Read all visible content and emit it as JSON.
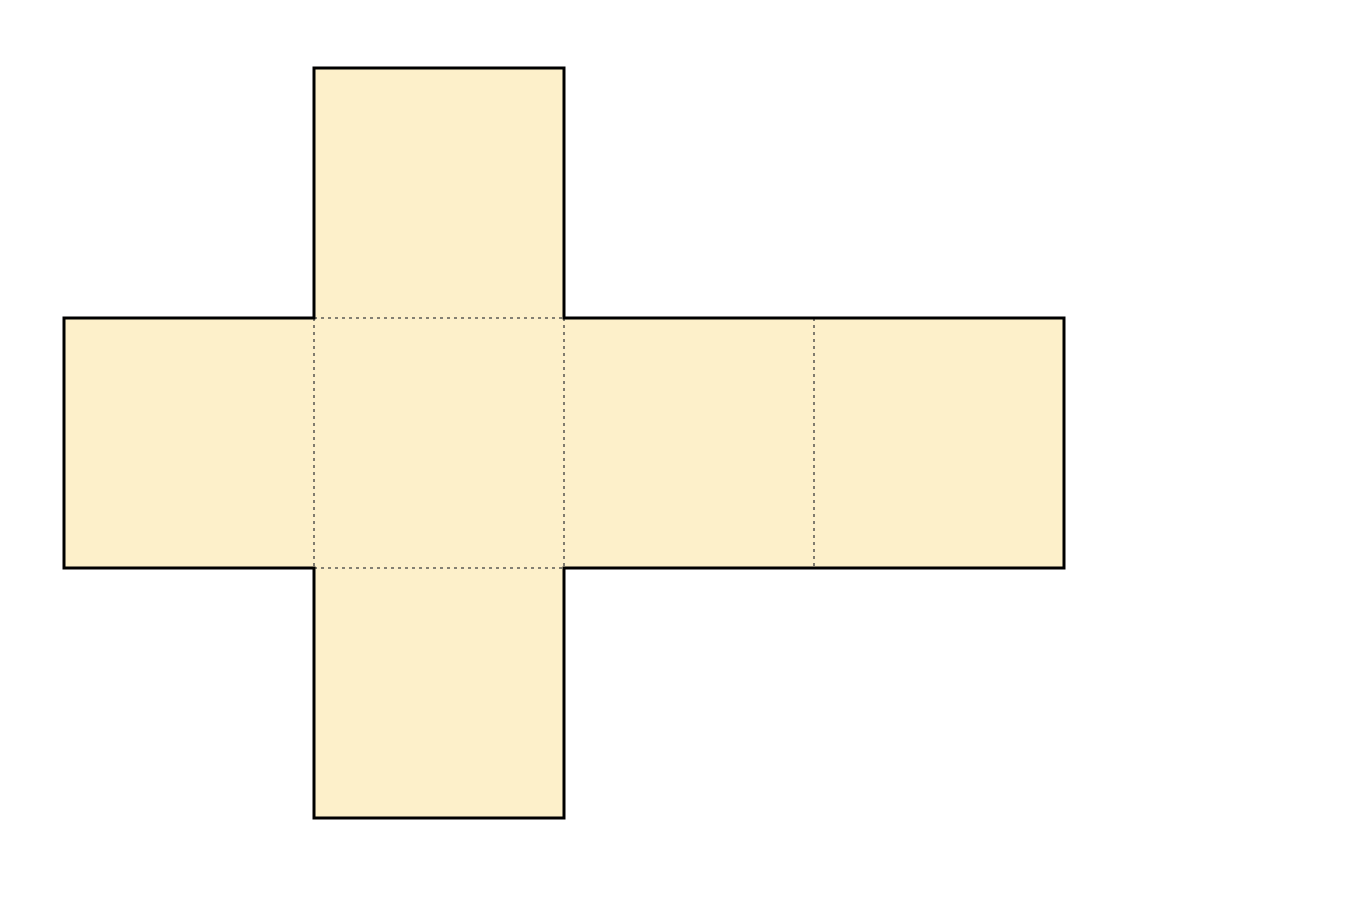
{
  "diagram": {
    "kind": "cube-net",
    "description": "Unfolded cube net: horizontal row of four squares with one square flap above and one below the second square",
    "canvas": {
      "width": 1352,
      "height": 899,
      "background": "#ffffff"
    },
    "style": {
      "face_fill": "#FDF0CA",
      "outline_color": "#000000",
      "outline_width": 3,
      "fold_line_color": "#3d3d3d",
      "fold_line_width": 1.3,
      "fold_line_dash": "3 4"
    },
    "grid": {
      "square_size": 250,
      "origin_x": 64,
      "origin_y": 68
    },
    "faces": [
      {
        "name": "face-top-flap",
        "x": 314,
        "y": 68,
        "w": 250,
        "h": 250
      },
      {
        "name": "face-row-left",
        "x": 64,
        "y": 318,
        "w": 250,
        "h": 250
      },
      {
        "name": "face-row-center",
        "x": 314,
        "y": 318,
        "w": 250,
        "h": 250
      },
      {
        "name": "face-row-right-1",
        "x": 564,
        "y": 318,
        "w": 250,
        "h": 250
      },
      {
        "name": "face-row-right-2",
        "x": 814,
        "y": 318,
        "w": 250,
        "h": 250
      },
      {
        "name": "face-bottom-flap",
        "x": 314,
        "y": 568,
        "w": 250,
        "h": 250
      }
    ],
    "outline_points": "314,68 564,68 564,318 1064,318 1064,568 564,568 564,818 314,818 314,568 64,568 64,318 314,318",
    "fold_lines": [
      {
        "name": "fold-top",
        "x1": 314,
        "y1": 318,
        "x2": 564,
        "y2": 318
      },
      {
        "name": "fold-left",
        "x1": 314,
        "y1": 318,
        "x2": 314,
        "y2": 568
      },
      {
        "name": "fold-center-right",
        "x1": 564,
        "y1": 318,
        "x2": 564,
        "y2": 568
      },
      {
        "name": "fold-far-right",
        "x1": 814,
        "y1": 318,
        "x2": 814,
        "y2": 568
      },
      {
        "name": "fold-bottom",
        "x1": 314,
        "y1": 568,
        "x2": 564,
        "y2": 568
      }
    ]
  }
}
